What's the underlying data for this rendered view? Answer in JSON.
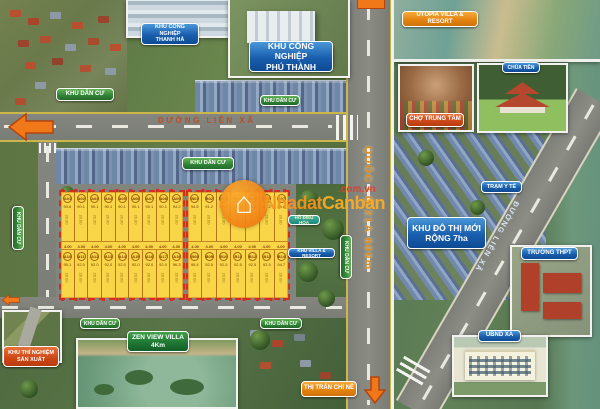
{
  "watermark": {
    "brand_prefix": "Nhadat",
    "brand_suffix": "Canban",
    "domain": ".com.vn"
  },
  "roads": {
    "lien_xa": "ĐƯỜNG LIÊN XÃ",
    "quoc_lo": "QUỐC LỘ 21A 600m"
  },
  "labels": {
    "thanh_ha": "KHU CÔNG NGHIỆP\nTHANH HÀ",
    "phu_thanh": "KHU CÔNG NGHIỆP\nPHÚ THÀNH",
    "khu_dan_cu": "KHU DÂN CƯ",
    "utopia": "UTOPIA VILLA & RESORT",
    "chua_tien": "CHÙA TIÊN",
    "cho_trung_tam": "CHỢ TRUNG TÂM",
    "tram_y_te": "TRẠM Y TẾ",
    "khu_do_thi": "KHU ĐÔ THỊ MỚI\nRỘNG 7ha",
    "truong_thpt": "TRƯỜNG THPT",
    "ubnd_xa": "UBND XÃ",
    "thi_tran_chi_ne": "THỊ TRẤN CHI NÊ",
    "zen_view": "ZEN VIEW VILLA\n4Km",
    "thi_nghiem": "KHU THÍ NGHIỆM\nSẢN XUẤT",
    "ho_dieu_hoa": "HỒ ĐIỀU HÒA",
    "villa_resort": "KHU VILLA & RESORT"
  },
  "plots": {
    "width_label": "4.00",
    "depth_label": "20.00",
    "block_a": {
      "rows": [
        [
          {
            "id": "A01",
            "area": "93.6"
          },
          {
            "id": "A02",
            "area": "90.1"
          },
          {
            "id": "A03",
            "area": "90.1"
          },
          {
            "id": "A04",
            "area": "90.1"
          },
          {
            "id": "A05",
            "area": "90.1"
          },
          {
            "id": "A06",
            "area": "90.1"
          },
          {
            "id": "A07",
            "area": "90.1"
          },
          {
            "id": "A08",
            "area": "90.1"
          },
          {
            "id": "A09",
            "area": "94.2"
          }
        ],
        [
          {
            "id": "A10",
            "area": "95.1"
          },
          {
            "id": "A11",
            "area": "92.0"
          },
          {
            "id": "A12",
            "area": "92.0"
          },
          {
            "id": "A13",
            "area": "92.0"
          },
          {
            "id": "A14",
            "area": "92.0"
          },
          {
            "id": "A15",
            "area": "92.0"
          },
          {
            "id": "A16",
            "area": "92.0"
          },
          {
            "id": "A17",
            "area": "92.0"
          },
          {
            "id": "A18",
            "area": "96.3"
          }
        ]
      ]
    },
    "block_b": {
      "rows": [
        [
          {
            "id": "B01",
            "area": "94.5"
          },
          {
            "id": "B02",
            "area": "91.2"
          },
          {
            "id": "B03",
            "area": "91.2"
          },
          {
            "id": "B04",
            "area": "91.2"
          },
          {
            "id": "B05",
            "area": "91.2"
          },
          {
            "id": "B06",
            "area": "91.2"
          },
          {
            "id": "B07",
            "area": "93.8"
          }
        ],
        [
          {
            "id": "B08",
            "area": "95.4"
          },
          {
            "id": "B09",
            "area": "92.5"
          },
          {
            "id": "B10",
            "area": "92.5"
          },
          {
            "id": "B11",
            "area": "92.5"
          },
          {
            "id": "B12",
            "area": "92.5"
          },
          {
            "id": "B13",
            "area": "92.5"
          },
          {
            "id": "B14",
            "area": "94.7"
          }
        ]
      ]
    }
  },
  "colors": {
    "label_blue": "#1a5fae",
    "label_green": "#2f8336",
    "label_orange": "#e2820e",
    "label_red_orange": "#cc4716",
    "label_teal": "#1f8a7c",
    "plot_yellow": "#f8d648",
    "plot_border_red": "#d03022",
    "road_text_orange": "#e2891c",
    "watermark_orange": "#f7941d",
    "watermark_red": "#e03c31"
  }
}
